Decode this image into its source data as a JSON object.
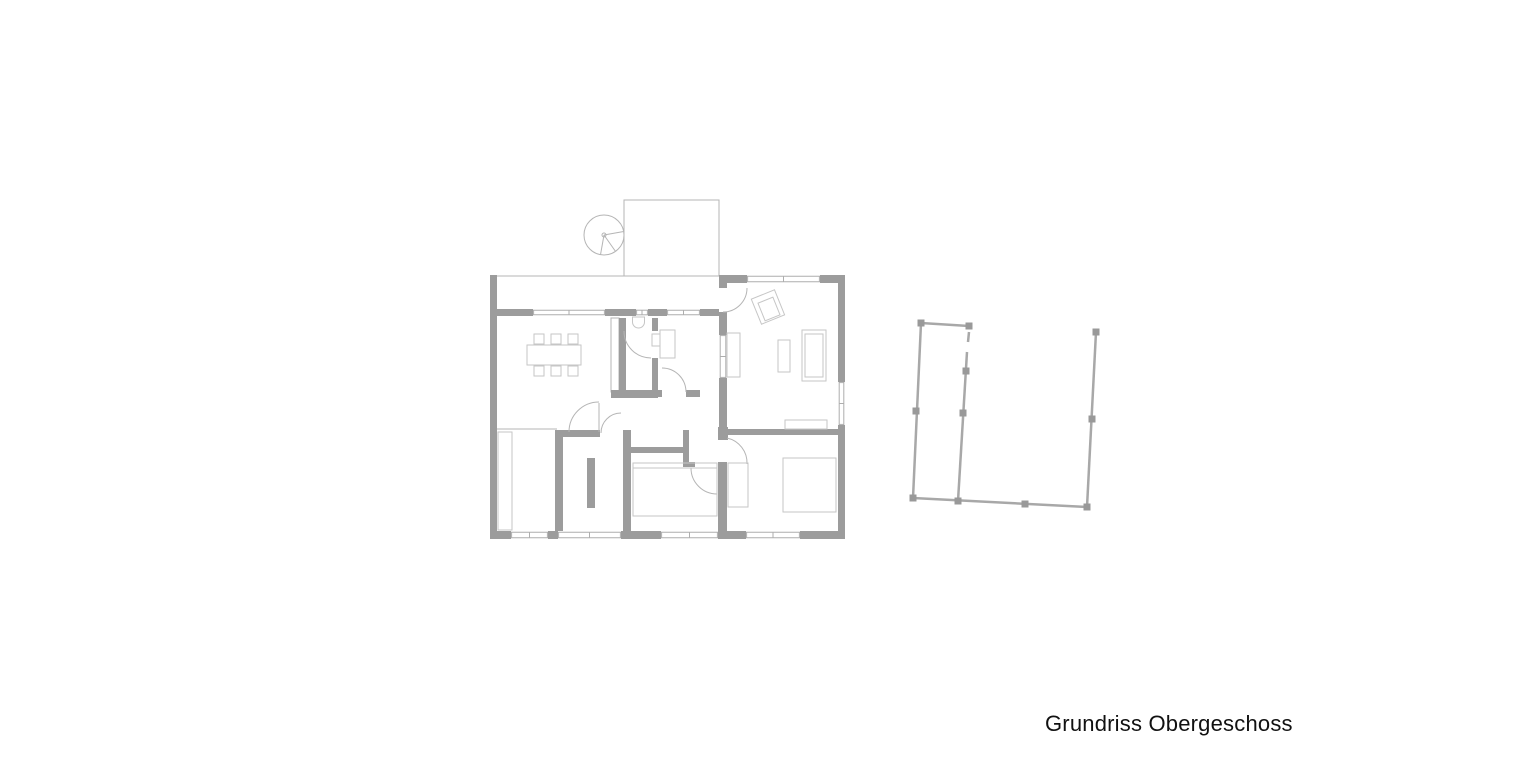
{
  "caption": {
    "text": "Grundriss Obergeschoss"
  },
  "canvas": {
    "width": 1540,
    "height": 770
  },
  "colors": {
    "background": "#ffffff",
    "wall": "#9c9c9c",
    "line_thin": "#b5b5b5",
    "window_line": "#aeaeae",
    "furniture": "#c6c6c6",
    "railing": "#a8a8a8",
    "railing_post": "#999999",
    "text": "#111111"
  },
  "floor_plan": {
    "thin_lines": [
      [
        497,
        276,
        624,
        276,
        "terrace-walkway-edge"
      ],
      [
        497,
        429,
        557,
        429,
        "closet-room-top-line"
      ]
    ],
    "thin_rects": [
      {
        "r": [
          624,
          200,
          95,
          76
        ],
        "fill": "none",
        "name": "terrace-outline"
      },
      {
        "r": [
          611,
          318,
          8,
          74
        ],
        "fill": "#ffffff",
        "name": "pocket-wall"
      }
    ],
    "stair": {
      "cx": 604,
      "cy": 235,
      "r": 20,
      "hub_r": 2,
      "spokes": [
        [
          623.7,
          231.5
        ],
        [
          615.5,
          251.4
        ],
        [
          600.5,
          254.7
        ]
      ],
      "name": "spiral-stair"
    },
    "walls": [
      [
        490,
        275,
        7,
        263,
        "outer-wall-left"
      ],
      [
        490,
        531,
        21,
        8,
        "outer-wall-bottom-1"
      ],
      [
        548,
        531,
        10,
        8,
        "outer-wall-bottom-2"
      ],
      [
        621,
        531,
        40,
        8,
        "outer-wall-bottom-3"
      ],
      [
        718,
        531,
        28,
        8,
        "outer-wall-bottom-4"
      ],
      [
        800,
        531,
        45,
        8,
        "outer-wall-bottom-5"
      ],
      [
        838,
        277,
        7,
        105,
        "outer-wall-right-upper"
      ],
      [
        838,
        425,
        7,
        114,
        "outer-wall-right-lower"
      ],
      [
        719,
        275,
        28,
        8,
        "outer-wall-top-right-a"
      ],
      [
        820,
        275,
        25,
        8,
        "outer-wall-top-right-b"
      ],
      [
        497,
        309,
        36,
        7,
        "upper-wall-a"
      ],
      [
        605,
        309,
        31,
        7,
        "upper-wall-b"
      ],
      [
        648,
        309,
        19,
        7,
        "upper-wall-c"
      ],
      [
        700,
        309,
        19,
        7,
        "upper-wall-d"
      ],
      [
        719,
        283,
        8,
        5,
        "living-left-wall-a"
      ],
      [
        719,
        312,
        8,
        23,
        "living-left-wall-b"
      ],
      [
        719,
        378,
        8,
        52,
        "living-left-wall-c"
      ],
      [
        619,
        318,
        7,
        72,
        "pocket-wall-bar"
      ],
      [
        611,
        390,
        47,
        8,
        "wc-bottom-wall"
      ],
      [
        652,
        318,
        6,
        13,
        "wc-right-wall-a"
      ],
      [
        652,
        358,
        6,
        32,
        "wc-right-wall-b"
      ],
      [
        658,
        390,
        4,
        7,
        "office-bottom-wall-a"
      ],
      [
        686,
        390,
        14,
        7,
        "office-bottom-wall-b"
      ],
      [
        623,
        430,
        8,
        101,
        "hall-left-wall"
      ],
      [
        631,
        447,
        52,
        6,
        "hall-middle-wall"
      ],
      [
        683,
        430,
        6,
        37,
        "hall-middle-vertical"
      ],
      [
        683,
        462,
        12,
        5,
        "hall-wall-foot"
      ],
      [
        557,
        430,
        43,
        7,
        "closet-top-wall"
      ],
      [
        555,
        430,
        8,
        101,
        "stair-room-left-wall"
      ],
      [
        718,
        427,
        10,
        13,
        "bedroom-door-post"
      ],
      [
        727,
        429,
        111,
        6,
        "bedroom-top-wall"
      ],
      [
        718,
        462,
        9,
        69,
        "bedroom-left-wall"
      ],
      [
        587,
        458,
        8,
        50,
        "stair-room-partition"
      ]
    ],
    "windows": [
      {
        "r": [
          533,
          309,
          72,
          7
        ],
        "dir": "h",
        "name": "window-dining"
      },
      {
        "r": [
          636,
          309,
          12,
          7
        ],
        "dir": "h",
        "name": "window-wc"
      },
      {
        "r": [
          667,
          309,
          33,
          7
        ],
        "dir": "h",
        "name": "window-office"
      },
      {
        "r": [
          747,
          275,
          73,
          8
        ],
        "dir": "h",
        "name": "window-living-top"
      },
      {
        "r": [
          511,
          531,
          37,
          8
        ],
        "dir": "h",
        "name": "window-bottom-1"
      },
      {
        "r": [
          558,
          531,
          63,
          8
        ],
        "dir": "h",
        "name": "window-bottom-2"
      },
      {
        "r": [
          661,
          531,
          57,
          8
        ],
        "dir": "h",
        "name": "window-bottom-3"
      },
      {
        "r": [
          746,
          531,
          54,
          8
        ],
        "dir": "h",
        "name": "window-bottom-4"
      },
      {
        "r": [
          838,
          382,
          7,
          43
        ],
        "dir": "v",
        "name": "window-living-right"
      },
      {
        "r": [
          719,
          335,
          8,
          43
        ],
        "dir": "v",
        "name": "window-living-left"
      }
    ],
    "doors": [
      {
        "arc": "M747,288 A24,24 0 0 1 723,312",
        "leaf": null,
        "name": "door-terrace-living"
      },
      {
        "arc": "M569,432 A30,30 0 0 1 599,402",
        "leaf": [
          599,
          403,
          599,
          432
        ],
        "name": "door-dining"
      },
      {
        "arc": "M601,433 A20,20 0 0 1 621,413",
        "leaf": null,
        "name": "door-hall"
      },
      {
        "arc": "M624,331 A27,27 0 0 0 651,358",
        "leaf": null,
        "name": "door-wc"
      },
      {
        "arc": "M686,392 A24,24 0 0 0 662,368",
        "leaf": null,
        "name": "door-office"
      },
      {
        "arc": "M691,468 A26,26 0 0 0 717,494",
        "leaf": [
          691,
          468,
          717,
          468
        ],
        "name": "door-middle-room"
      },
      {
        "arc": "M727,438 A25.5,25.5 0 0 1 747,464",
        "leaf": null,
        "name": "door-bedroom"
      }
    ],
    "furniture_rects": [
      [
        527,
        345,
        54,
        20,
        "dining-table"
      ],
      [
        534,
        334,
        10,
        10,
        "chair"
      ],
      [
        551,
        334,
        10,
        10,
        "chair"
      ],
      [
        568,
        334,
        10,
        10,
        "chair"
      ],
      [
        534,
        366,
        10,
        10,
        "chair"
      ],
      [
        551,
        366,
        10,
        10,
        "chair"
      ],
      [
        568,
        366,
        10,
        10,
        "chair"
      ],
      [
        498,
        432,
        14,
        98,
        "wardrobe-closet"
      ],
      [
        660,
        330,
        15,
        28,
        "office-desk"
      ],
      [
        652,
        334,
        8,
        12,
        "office-chair"
      ],
      [
        727,
        333,
        13,
        44,
        "living-shelf"
      ],
      [
        778,
        340,
        12,
        32,
        "coffee-table"
      ],
      [
        802,
        330,
        24,
        51,
        "sofa-outer"
      ],
      [
        805,
        334,
        18,
        43,
        "sofa-inner"
      ],
      [
        785,
        420,
        42,
        9,
        "sideboard"
      ],
      [
        783,
        458,
        53,
        54,
        "bed"
      ],
      [
        728,
        463,
        20,
        44,
        "bedroom-wardrobe"
      ],
      [
        633,
        463,
        84,
        53,
        "bathtub"
      ]
    ],
    "furniture_lines": [
      [
        633,
        468,
        717,
        468,
        "bathtub-rim-line"
      ]
    ],
    "armchair": {
      "outer": "774.5,289.8 784.6,314.8 761.5,324.2 751.3,299.2",
      "inner": "772.9,297.2 780,314.8 765.1,320.8 758,303.2",
      "name": "armchair-rotated"
    },
    "toilet": {
      "path": "M632.5,317 h12 v5 a6,6 0 0 1 -12,0 z",
      "name": "toilet"
    }
  },
  "railing": {
    "rails": [
      [
        921,
        323,
        969,
        326,
        "rail-top"
      ],
      [
        921,
        323,
        913,
        498,
        "rail-left"
      ],
      [
        913,
        498,
        1087,
        507,
        "rail-bottom"
      ],
      [
        969,
        332,
        968,
        342,
        "rail-inner-stub"
      ],
      [
        967,
        352,
        958,
        501,
        "rail-inner"
      ],
      [
        1096,
        332,
        1087,
        507,
        "rail-right"
      ]
    ],
    "posts": [
      [
        921,
        323
      ],
      [
        969,
        326
      ],
      [
        916,
        411
      ],
      [
        913,
        498
      ],
      [
        958,
        501
      ],
      [
        1025,
        504
      ],
      [
        1087,
        507
      ],
      [
        1096,
        332
      ],
      [
        1092,
        419
      ],
      [
        963,
        413
      ],
      [
        966,
        371
      ]
    ],
    "post_size": 7,
    "name": "terrace-railing-plan"
  }
}
